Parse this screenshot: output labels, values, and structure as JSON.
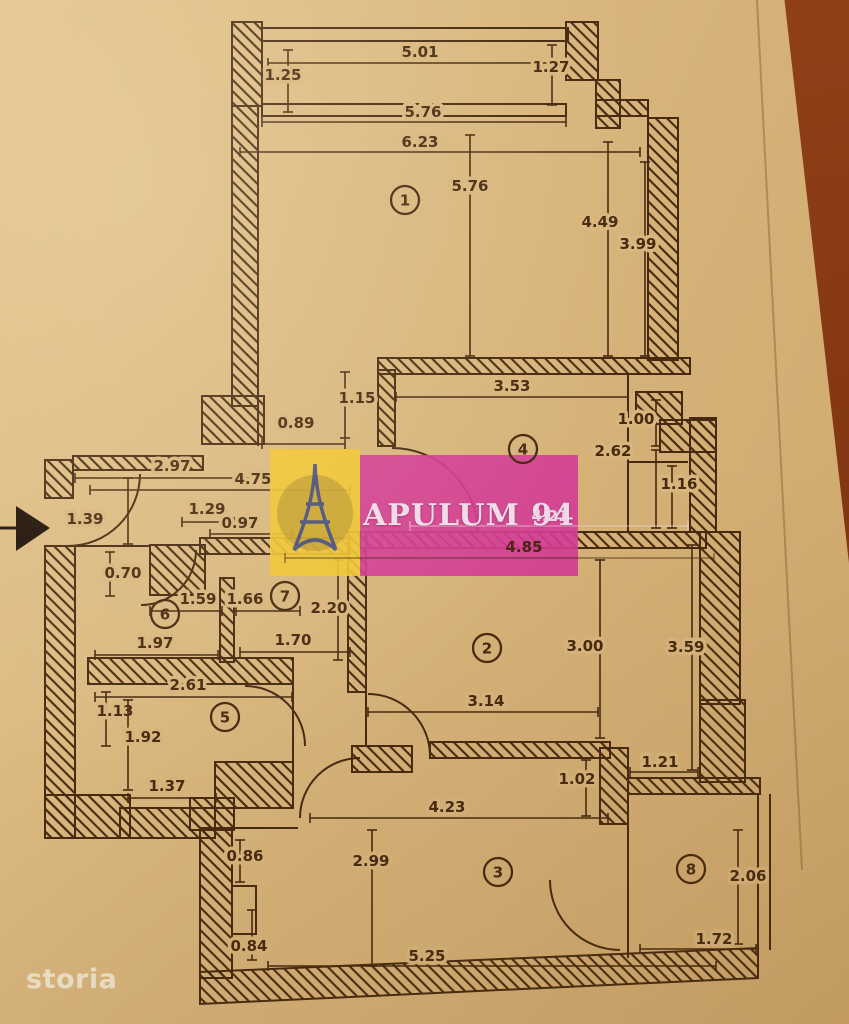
{
  "watermark": {
    "brand": "APULUM 94",
    "logo": "eiffel-tower-icon",
    "pink": "#d33b94",
    "yellow": "#efc531",
    "logo_blue": "#2e3d8c"
  },
  "footer_logo": "storia",
  "colors": {
    "paper": "#d8b57c",
    "ink": "#46290f",
    "table": "#8a3a14",
    "arrow_black": "#1c0e05"
  },
  "plan": {
    "rooms": [
      {
        "n": "1",
        "x": 405,
        "y": 200
      },
      {
        "n": "2",
        "x": 487,
        "y": 648
      },
      {
        "n": "3",
        "x": 498,
        "y": 872
      },
      {
        "n": "4",
        "x": 523,
        "y": 449
      },
      {
        "n": "5",
        "x": 225,
        "y": 717
      },
      {
        "n": "6",
        "x": 165,
        "y": 614
      },
      {
        "n": "7",
        "x": 285,
        "y": 596
      },
      {
        "n": "8",
        "x": 691,
        "y": 869
      }
    ],
    "dimensions": [
      {
        "v": "5.01",
        "lx": 420,
        "ly": 57,
        "x1": 268,
        "y1": 63,
        "x2": 556,
        "y2": 63
      },
      {
        "v": "1.25",
        "lx": 283,
        "ly": 80,
        "x1": 288,
        "y1": 50,
        "x2": 288,
        "y2": 112
      },
      {
        "v": "1.27",
        "lx": 551,
        "ly": 72,
        "x1": 552,
        "y1": 45,
        "x2": 552,
        "y2": 105
      },
      {
        "v": "5.76",
        "lx": 423,
        "ly": 117,
        "x1": 262,
        "y1": 122,
        "x2": 566,
        "y2": 122
      },
      {
        "v": "6.23",
        "lx": 420,
        "ly": 147,
        "x1": 240,
        "y1": 152,
        "x2": 640,
        "y2": 152
      },
      {
        "v": "5.76",
        "lx": 470,
        "ly": 191,
        "x1": 470,
        "y1": 135,
        "x2": 470,
        "y2": 356
      },
      {
        "v": "4.49",
        "lx": 600,
        "ly": 227,
        "x1": 608,
        "y1": 142,
        "x2": 608,
        "y2": 356
      },
      {
        "v": "3.99",
        "lx": 638,
        "ly": 249,
        "x1": 645,
        "y1": 162,
        "x2": 645,
        "y2": 356
      },
      {
        "v": "1.15",
        "lx": 357,
        "ly": 403,
        "x1": 345,
        "y1": 372,
        "x2": 345,
        "y2": 438
      },
      {
        "v": "0.89",
        "lx": 296,
        "ly": 428,
        "x1": 262,
        "y1": 444,
        "x2": 345,
        "y2": 444
      },
      {
        "v": "3.53",
        "lx": 512,
        "ly": 391,
        "x1": 396,
        "y1": 397,
        "x2": 628,
        "y2": 397
      },
      {
        "v": "1.00",
        "lx": 636,
        "ly": 424,
        "x1": 656,
        "y1": 400,
        "x2": 656,
        "y2": 446
      },
      {
        "v": "2.62",
        "lx": 613,
        "ly": 456,
        "x1": 656,
        "y1": 450,
        "x2": 656,
        "y2": 528
      },
      {
        "v": "1.16",
        "lx": 679,
        "ly": 489,
        "x1": 672,
        "y1": 466,
        "x2": 672,
        "y2": 528
      },
      {
        "v": "2.97",
        "lx": 172,
        "ly": 471,
        "x1": 75,
        "y1": 478,
        "x2": 268,
        "y2": 478
      },
      {
        "v": "4.75",
        "lx": 253,
        "ly": 484,
        "x1": 90,
        "y1": 490,
        "x2": 350,
        "y2": 490
      },
      {
        "v": "1.39",
        "lx": 85,
        "ly": 524,
        "x1": 128,
        "y1": 478,
        "x2": 128,
        "y2": 544
      },
      {
        "v": "1.29",
        "lx": 207,
        "ly": 514,
        "x1": 182,
        "y1": 522,
        "x2": 234,
        "y2": 522
      },
      {
        "v": "0.97",
        "lx": 240,
        "ly": 528,
        "x1": 210,
        "y1": 534,
        "x2": 292,
        "y2": 534
      },
      {
        "v": "0.70",
        "lx": 123,
        "ly": 578,
        "x1": 110,
        "y1": 552,
        "x2": 110,
        "y2": 596
      },
      {
        "v": "1.59",
        "lx": 198,
        "ly": 604,
        "x1": 150,
        "y1": 611,
        "x2": 222,
        "y2": 611
      },
      {
        "v": "1.66",
        "lx": 245,
        "ly": 604,
        "x1": 236,
        "y1": 611,
        "x2": 300,
        "y2": 611
      },
      {
        "v": "2.20",
        "lx": 329,
        "ly": 613,
        "x1": 338,
        "y1": 560,
        "x2": 338,
        "y2": 660
      },
      {
        "v": "1.97",
        "lx": 155,
        "ly": 648,
        "x1": 95,
        "y1": 655,
        "x2": 218,
        "y2": 655
      },
      {
        "v": "1.70",
        "lx": 293,
        "ly": 645,
        "x1": 240,
        "y1": 652,
        "x2": 350,
        "y2": 652
      },
      {
        "v": "2.61",
        "lx": 188,
        "ly": 690,
        "x1": 95,
        "y1": 697,
        "x2": 292,
        "y2": 697
      },
      {
        "v": "1.13",
        "lx": 115,
        "ly": 716,
        "x1": 106,
        "y1": 692,
        "x2": 106,
        "y2": 746
      },
      {
        "v": "1.92",
        "lx": 143,
        "ly": 742,
        "x1": 128,
        "y1": 700,
        "x2": 128,
        "y2": 790
      },
      {
        "v": "1.37",
        "lx": 167,
        "ly": 791,
        "x1": 128,
        "y1": 798,
        "x2": 216,
        "y2": 798
      },
      {
        "v": "3.00",
        "lx": 585,
        "ly": 651,
        "x1": 600,
        "y1": 560,
        "x2": 600,
        "y2": 738
      },
      {
        "v": "3.59",
        "lx": 686,
        "ly": 652,
        "x1": 692,
        "y1": 545,
        "x2": 692,
        "y2": 770
      },
      {
        "v": "3.14",
        "lx": 486,
        "ly": 706,
        "x1": 368,
        "y1": 712,
        "x2": 598,
        "y2": 712
      },
      {
        "v": "1.02",
        "lx": 577,
        "ly": 784,
        "x1": 586,
        "y1": 760,
        "x2": 586,
        "y2": 816
      },
      {
        "v": "1.21",
        "lx": 660,
        "ly": 767,
        "x1": 630,
        "y1": 772,
        "x2": 698,
        "y2": 772
      },
      {
        "v": "4.23",
        "lx": 447,
        "ly": 812,
        "x1": 310,
        "y1": 818,
        "x2": 608,
        "y2": 818
      },
      {
        "v": "0.86",
        "lx": 245,
        "ly": 861,
        "x1": 240,
        "y1": 840,
        "x2": 240,
        "y2": 882
      },
      {
        "v": "2.99",
        "lx": 371,
        "ly": 866,
        "x1": 372,
        "y1": 830,
        "x2": 372,
        "y2": 966
      },
      {
        "v": "2.06",
        "lx": 748,
        "ly": 881,
        "x1": 738,
        "y1": 830,
        "x2": 738,
        "y2": 944
      },
      {
        "v": "0.84",
        "lx": 249,
        "ly": 951,
        "x1": 252,
        "y1": 910,
        "x2": 252,
        "y2": 960
      },
      {
        "v": "5.25",
        "lx": 427,
        "ly": 961,
        "x1": 268,
        "y1": 966,
        "x2": 716,
        "y2": 966
      },
      {
        "v": "1.72",
        "lx": 714,
        "ly": 944,
        "x1": 640,
        "y1": 949,
        "x2": 756,
        "y2": 949
      },
      {
        "v": "4.85",
        "lx": 524,
        "ly": 552,
        "x1": 285,
        "y1": 558,
        "x2": 714,
        "y2": 558,
        "layer": "top",
        "fill": "#4a2213",
        "line": "rgba(70,41,15,0.55)",
        "mask": false
      },
      {
        "v": "4.21",
        "lx": 550,
        "ly": 521,
        "x1": 410,
        "y1": 526,
        "x2": 688,
        "y2": 526,
        "layer": "top",
        "fill": "#e9d3e3",
        "line": "rgba(238,216,232,0.45)",
        "mask": false
      }
    ]
  }
}
